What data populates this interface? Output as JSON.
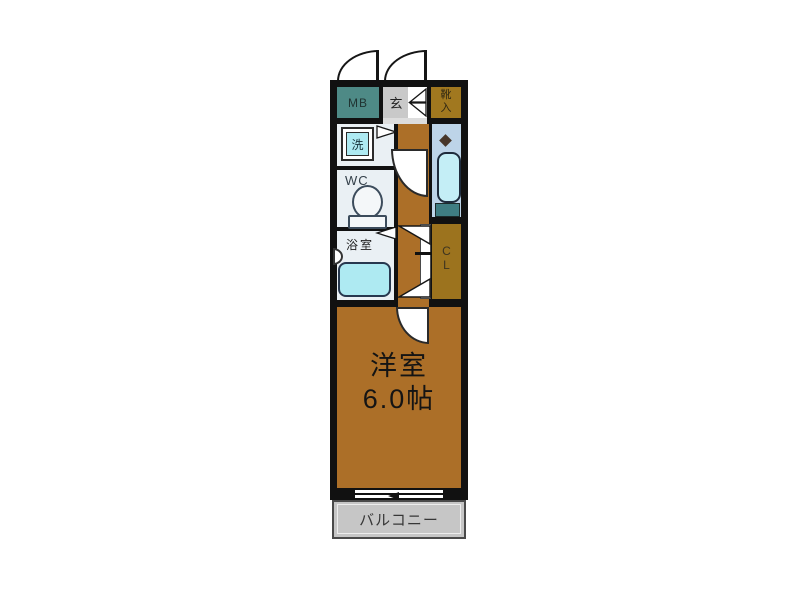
{
  "floorplan": {
    "meter_box": {
      "label": "MB"
    },
    "entrance": {
      "label": "玄"
    },
    "shoe_cabinet": {
      "label": "靴入"
    },
    "washer": {
      "label": "洗"
    },
    "wc": {
      "label": "WC"
    },
    "bathroom": {
      "label": "浴室"
    },
    "closet": {
      "label": "CL"
    },
    "main_room": {
      "label": "洋室",
      "size": "6.0帖"
    },
    "balcony": {
      "label": "バルコニー"
    },
    "colors": {
      "wall": "#111111",
      "floor_brown": "#ac6f28",
      "meter_box_teal": "#4e8a86",
      "entrance_gray": "#c9c9c9",
      "shoe_cabinet_brown": "#a1781f",
      "closet_brown": "#9c731e",
      "wet_room_white": "#eaf0f4",
      "kitchen_blue": "#bdd4e8",
      "fixture_cyan": "#aeeaf2",
      "counter_teal": "#3f7d82",
      "balcony_gray": "#c6c6c6"
    }
  }
}
